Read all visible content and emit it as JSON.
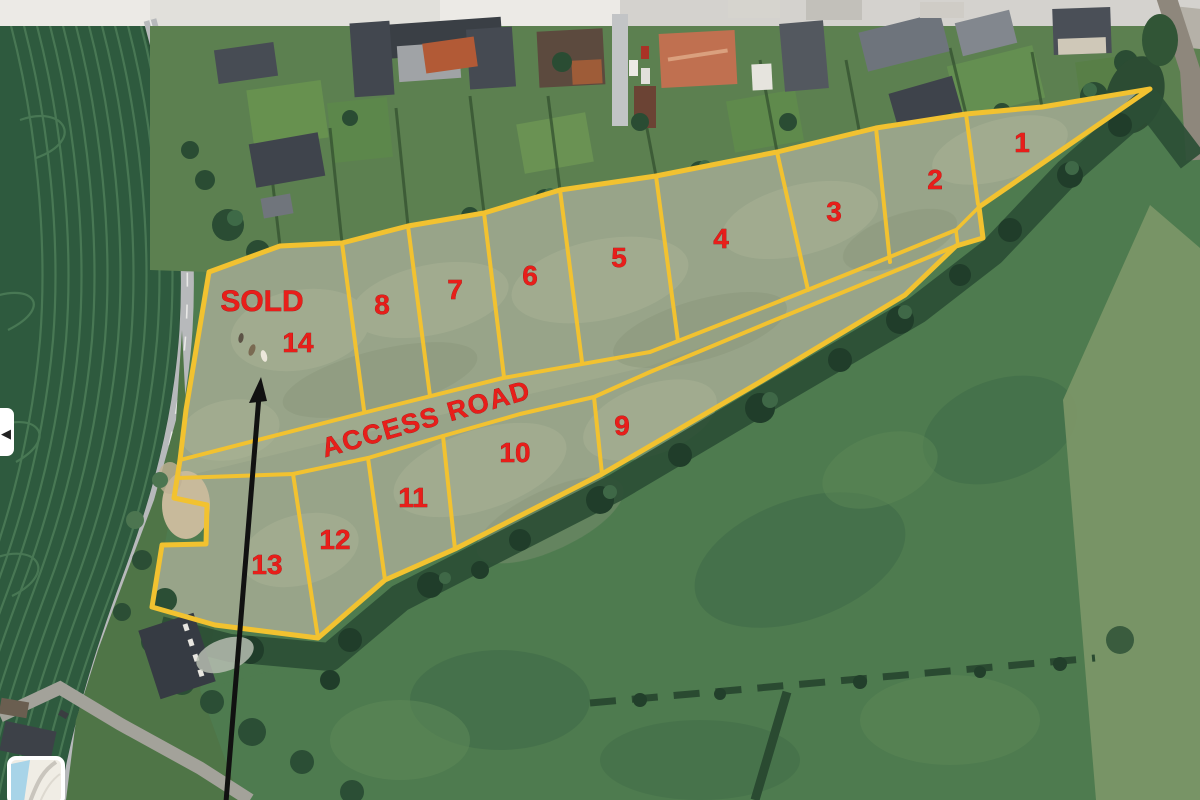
{
  "map": {
    "description": "Aerial satellite view of a field divided into numbered sale plots outlined in yellow",
    "sold_label": "SOLD",
    "access_road_label": "ACCESS ROAD",
    "plots": [
      {
        "id": 1,
        "label": "1"
      },
      {
        "id": 2,
        "label": "2"
      },
      {
        "id": 3,
        "label": "3"
      },
      {
        "id": 4,
        "label": "4"
      },
      {
        "id": 5,
        "label": "5"
      },
      {
        "id": 6,
        "label": "6"
      },
      {
        "id": 7,
        "label": "7"
      },
      {
        "id": 8,
        "label": "8"
      },
      {
        "id": 9,
        "label": "9"
      },
      {
        "id": 10,
        "label": "10"
      },
      {
        "id": 11,
        "label": "11"
      },
      {
        "id": 12,
        "label": "12"
      },
      {
        "id": 13,
        "label": "13"
      },
      {
        "id": 14,
        "label": "14",
        "status": "SOLD"
      }
    ]
  },
  "annotations": {
    "boundary_color": "#F2C230",
    "label_color": "#E81E1A",
    "arrow_color": "#111111"
  },
  "controls": {
    "left_toggle_glyph": "◀"
  }
}
